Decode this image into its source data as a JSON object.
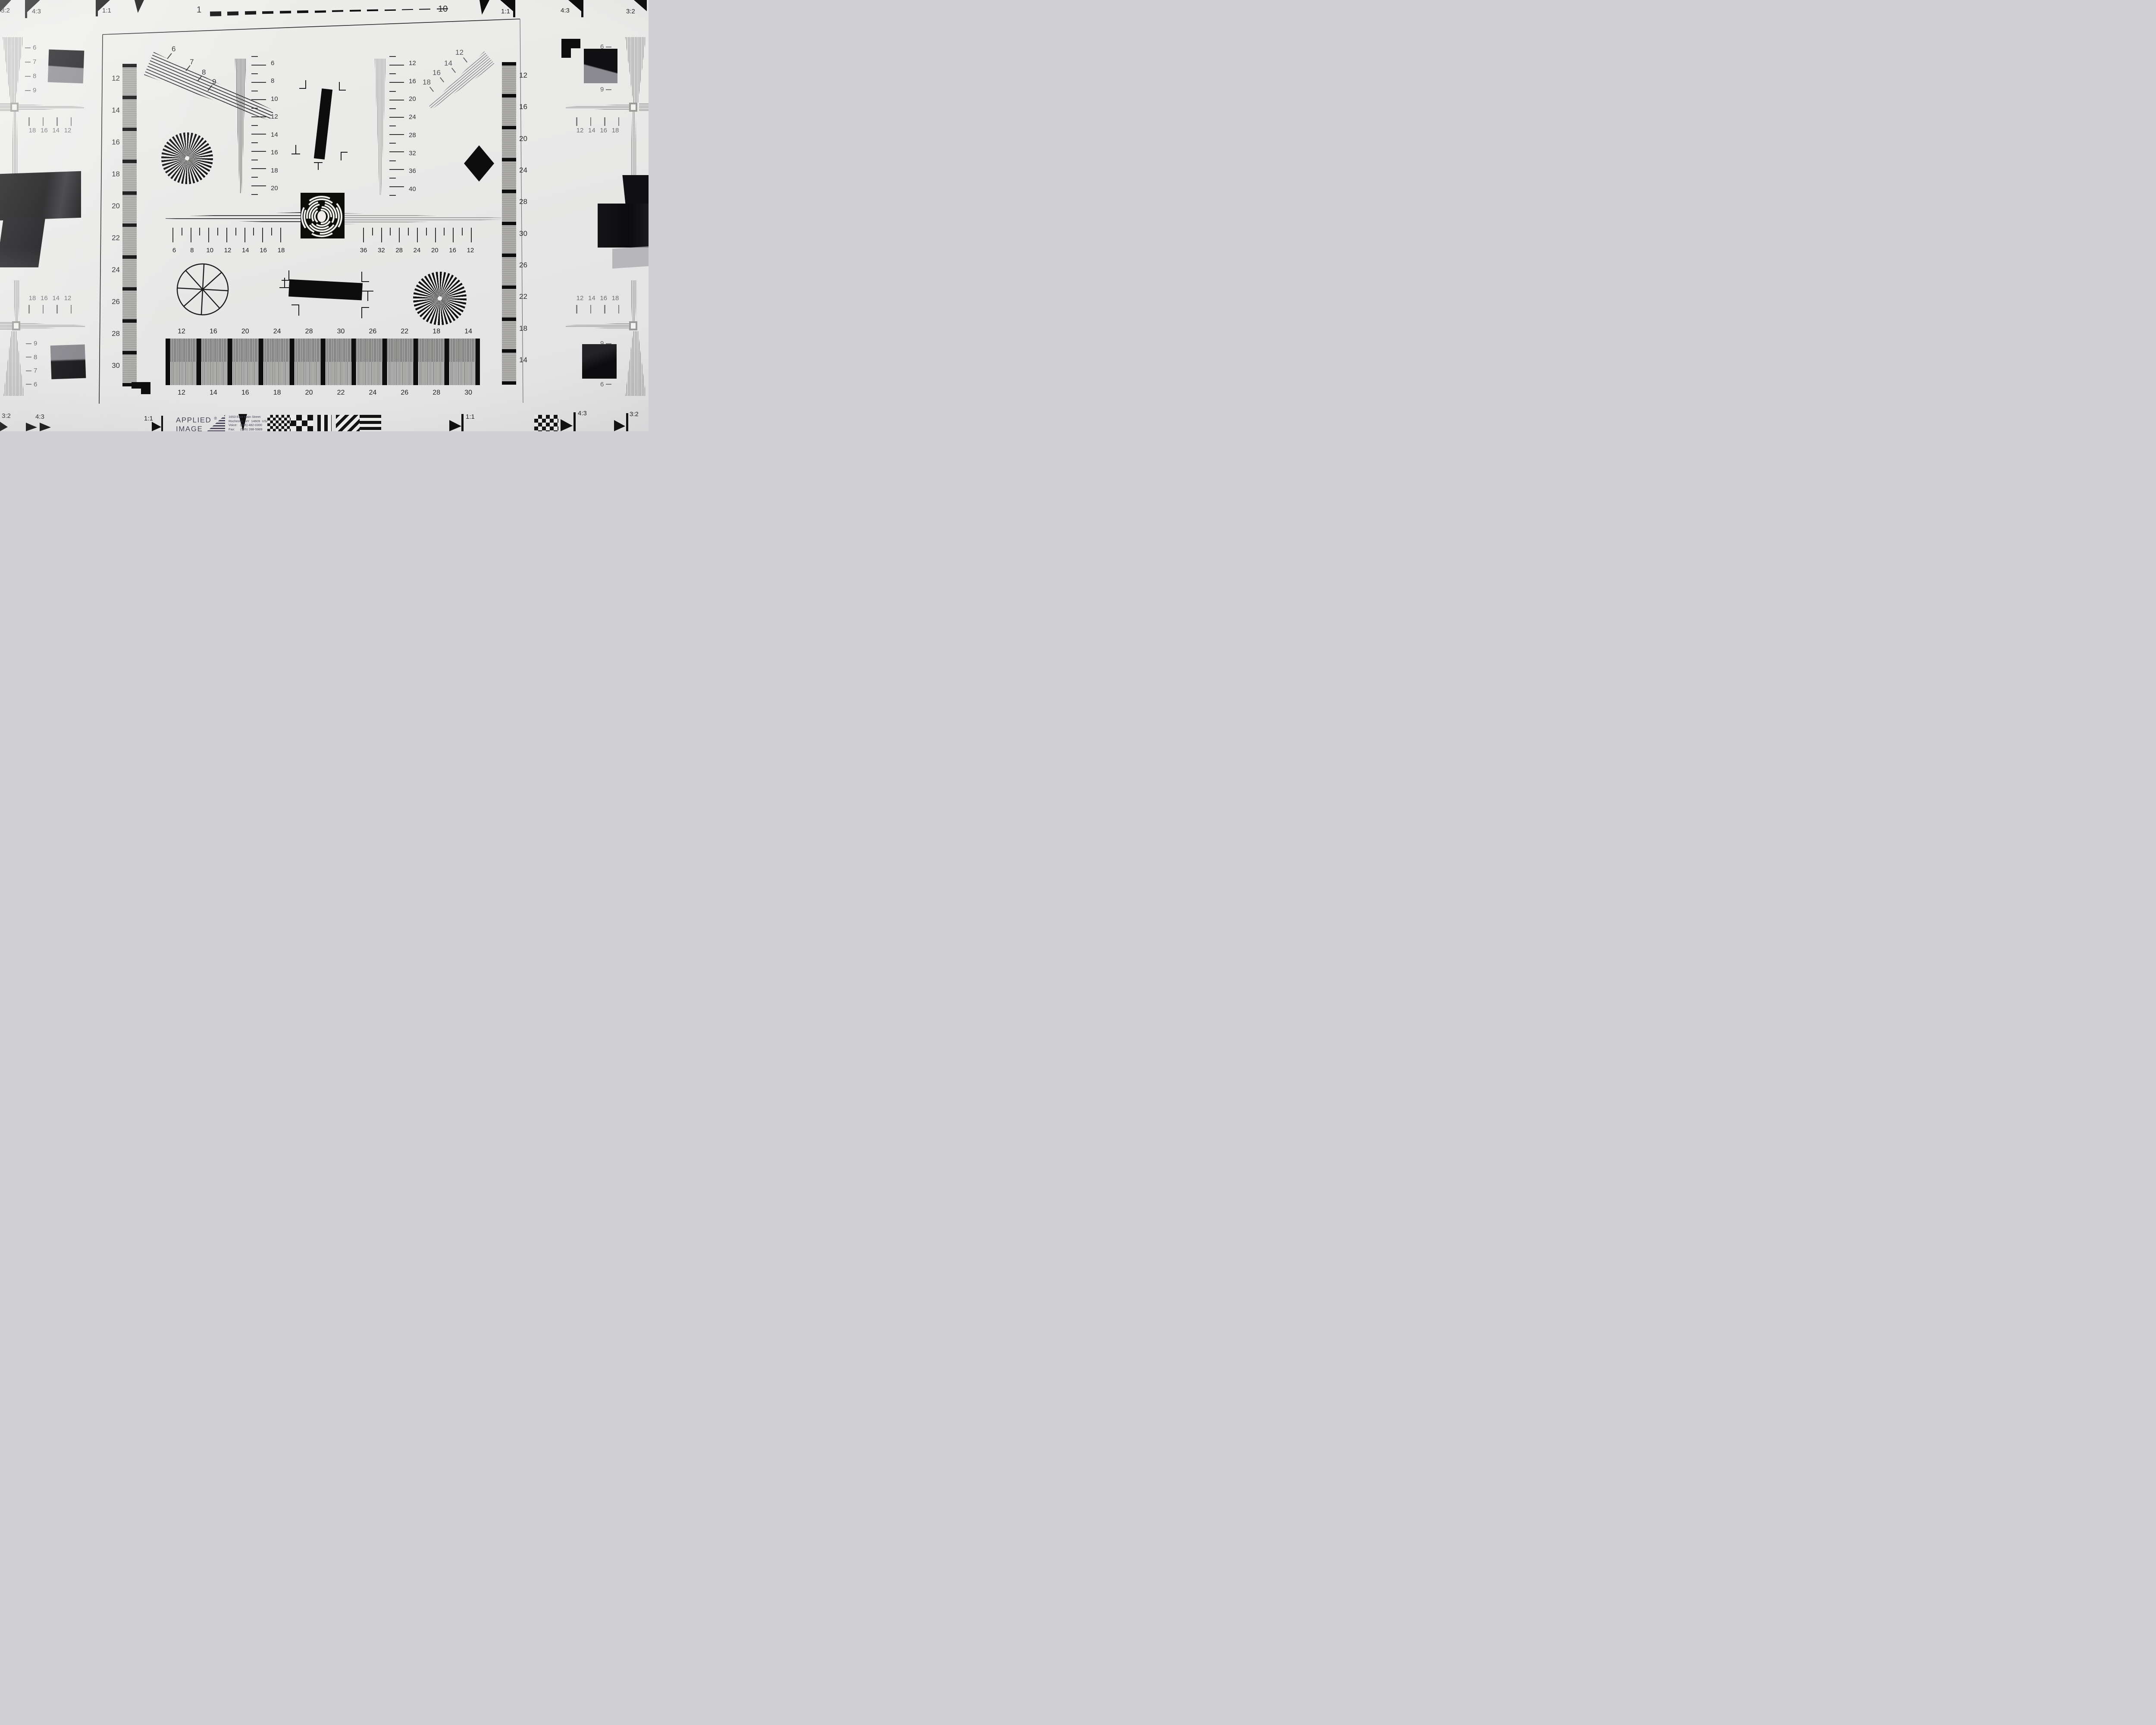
{
  "top_edge": {
    "scale_start": "1",
    "scale_end": "10",
    "left_ratios": [
      "3:2",
      "4:3",
      "1:1"
    ],
    "right_ratios": [
      "1:1",
      "4:3",
      "3:2"
    ]
  },
  "bottom_edge": {
    "left_ratios": [
      "3:2",
      "4:3",
      "1:1"
    ],
    "right_ratios": [
      "1:1",
      "4:3",
      "3:2"
    ]
  },
  "corners": {
    "top_left": {
      "fan_labels": [
        "6",
        "7",
        "8",
        "9"
      ],
      "tick_labels": [
        "18",
        "16",
        "14",
        "12"
      ]
    },
    "top_right": {
      "fan_labels": [
        "6",
        "7",
        "8",
        "9"
      ],
      "tick_labels": [
        "12",
        "14",
        "16",
        "18"
      ]
    },
    "bottom_left": {
      "fan_labels": [
        "9",
        "8",
        "7",
        "6"
      ],
      "tick_labels": [
        "18",
        "16",
        "14",
        "12"
      ]
    },
    "bottom_right": {
      "fan_labels": [
        "9",
        "8",
        "7",
        "6"
      ],
      "tick_labels": [
        "12",
        "14",
        "16",
        "18"
      ]
    }
  },
  "left_strip_labels": [
    "12",
    "14",
    "16",
    "18",
    "20",
    "22",
    "24",
    "26",
    "28",
    "30"
  ],
  "right_strip_labels": [
    "12",
    "16",
    "20",
    "24",
    "28",
    "30",
    "26",
    "22",
    "18",
    "14"
  ],
  "upper_left_fan_labels": [
    "6",
    "7",
    "8",
    "9"
  ],
  "upper_right_fan_labels": [
    "12",
    "14",
    "16",
    "18"
  ],
  "left_wedge_scale": [
    "6",
    "8",
    "10",
    "12",
    "14",
    "16",
    "18",
    "20"
  ],
  "right_wedge_scale": [
    "12",
    "16",
    "20",
    "24",
    "28",
    "32",
    "36",
    "40"
  ],
  "center_scale_left": [
    "6",
    "8",
    "10",
    "12",
    "14",
    "16",
    "18"
  ],
  "center_scale_right": [
    "36",
    "32",
    "28",
    "24",
    "20",
    "16",
    "12"
  ],
  "bottom_band": {
    "top_labels": [
      "12",
      "16",
      "20",
      "24",
      "28",
      "30",
      "26",
      "22",
      "18",
      "14"
    ],
    "bottom_labels": [
      "12",
      "14",
      "16",
      "18",
      "20",
      "22",
      "24",
      "26",
      "28",
      "30"
    ]
  },
  "logo": {
    "name_line1": "APPLIED",
    "registered": "®",
    "name_line2": "IMAGE",
    "name_line3": "Inc.",
    "address_lines": [
      "1653 East Main Street",
      "Rochester, NY  14609  USA",
      "Voice:   (585) 482-0300",
      "Fax:      (585) 288-5989",
      "www.appliedimage.com"
    ]
  },
  "colors": {
    "paper": "#e9e9e8",
    "ink": "#141414",
    "gray_ink": "#6f6f6f",
    "logo_purple": "#4b4358"
  }
}
